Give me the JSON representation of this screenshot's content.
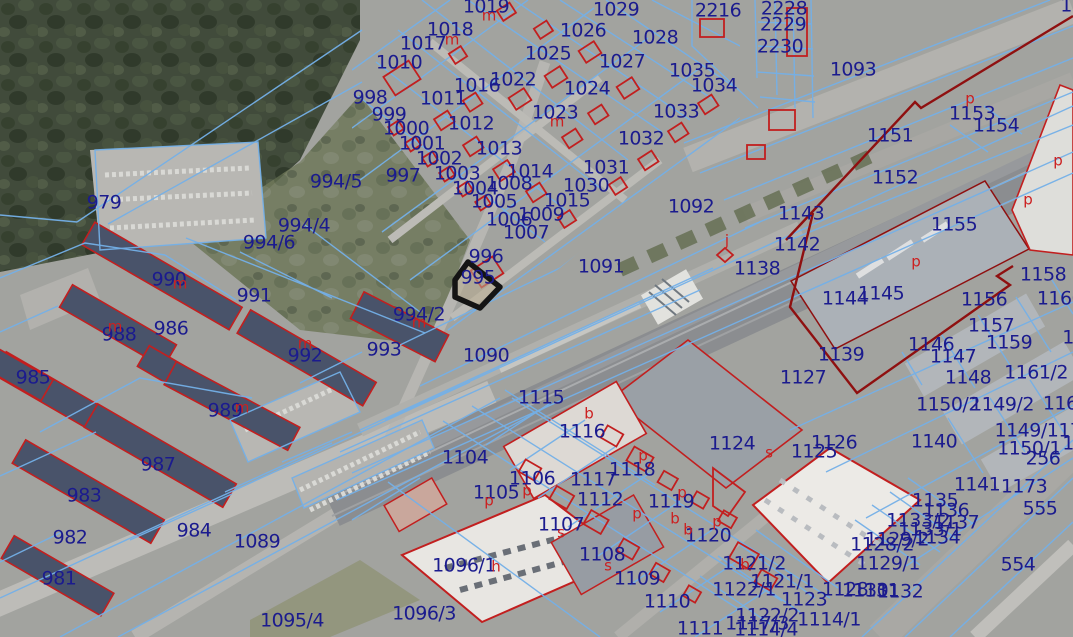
{
  "map": {
    "type": "cadastral-web-map",
    "colors": {
      "label": "#1b1b8e",
      "marker": "#cc2020",
      "boundary": "#74b0e8",
      "building_outline": "#c21f1f",
      "railway_boundary": "#8f1010",
      "selected_outline": "#141414",
      "selected_fill": "#b9ad8f"
    },
    "selected_parcel": {
      "number": "995"
    },
    "parcel_labels": [
      {
        "t": "979",
        "x": 104,
        "y": 203
      },
      {
        "t": "994/5",
        "x": 336,
        "y": 182
      },
      {
        "t": "994/4",
        "x": 304,
        "y": 226
      },
      {
        "t": "994/6",
        "x": 269,
        "y": 243
      },
      {
        "t": "990",
        "x": 169,
        "y": 280
      },
      {
        "t": "991",
        "x": 254,
        "y": 296
      },
      {
        "t": "988",
        "x": 119,
        "y": 335
      },
      {
        "t": "986",
        "x": 171,
        "y": 329
      },
      {
        "t": "992",
        "x": 305,
        "y": 356
      },
      {
        "t": "985",
        "x": 33,
        "y": 378
      },
      {
        "t": "989",
        "x": 225,
        "y": 411
      },
      {
        "t": "987",
        "x": 158,
        "y": 465
      },
      {
        "t": "983",
        "x": 84,
        "y": 496
      },
      {
        "t": "982",
        "x": 70,
        "y": 538
      },
      {
        "t": "984",
        "x": 194,
        "y": 531
      },
      {
        "t": "1089",
        "x": 257,
        "y": 542
      },
      {
        "t": "981",
        "x": 59,
        "y": 579
      },
      {
        "t": "1095/4",
        "x": 292,
        "y": 621
      },
      {
        "t": "993",
        "x": 384,
        "y": 350
      },
      {
        "t": "994/2",
        "x": 419,
        "y": 315
      },
      {
        "t": "1019",
        "x": 486,
        "y": 7
      },
      {
        "t": "1029",
        "x": 616,
        "y": 10
      },
      {
        "t": "1018",
        "x": 450,
        "y": 30
      },
      {
        "t": "1017",
        "x": 423,
        "y": 44
      },
      {
        "t": "1026",
        "x": 583,
        "y": 31
      },
      {
        "t": "1028",
        "x": 655,
        "y": 38
      },
      {
        "t": "1010",
        "x": 399,
        "y": 63
      },
      {
        "t": "1025",
        "x": 548,
        "y": 54
      },
      {
        "t": "1027",
        "x": 622,
        "y": 62
      },
      {
        "t": "1035",
        "x": 692,
        "y": 71
      },
      {
        "t": "1016",
        "x": 477,
        "y": 86
      },
      {
        "t": "1022",
        "x": 513,
        "y": 80
      },
      {
        "t": "1024",
        "x": 587,
        "y": 89
      },
      {
        "t": "1034",
        "x": 714,
        "y": 86
      },
      {
        "t": "998",
        "x": 370,
        "y": 98
      },
      {
        "t": "1011",
        "x": 443,
        "y": 99
      },
      {
        "t": "999",
        "x": 389,
        "y": 115
      },
      {
        "t": "1033",
        "x": 676,
        "y": 112
      },
      {
        "t": "1000",
        "x": 406,
        "y": 129
      },
      {
        "t": "1012",
        "x": 471,
        "y": 124
      },
      {
        "t": "1023",
        "x": 555,
        "y": 113
      },
      {
        "t": "1001",
        "x": 422,
        "y": 144
      },
      {
        "t": "1032",
        "x": 641,
        "y": 139
      },
      {
        "t": "1002",
        "x": 439,
        "y": 159
      },
      {
        "t": "1013",
        "x": 499,
        "y": 149
      },
      {
        "t": "997",
        "x": 403,
        "y": 176
      },
      {
        "t": "1003",
        "x": 457,
        "y": 174
      },
      {
        "t": "1031",
        "x": 606,
        "y": 168
      },
      {
        "t": "1004",
        "x": 475,
        "y": 189
      },
      {
        "t": "1008",
        "x": 509,
        "y": 184
      },
      {
        "t": "1014",
        "x": 530,
        "y": 172
      },
      {
        "t": "1030",
        "x": 586,
        "y": 186
      },
      {
        "t": "1005",
        "x": 494,
        "y": 202
      },
      {
        "t": "1015",
        "x": 567,
        "y": 201
      },
      {
        "t": "1006",
        "x": 509,
        "y": 220
      },
      {
        "t": "1009",
        "x": 541,
        "y": 215
      },
      {
        "t": "1007",
        "x": 526,
        "y": 233
      },
      {
        "t": "996",
        "x": 486,
        "y": 257
      },
      {
        "t": "995",
        "x": 478,
        "y": 278
      },
      {
        "t": "1091",
        "x": 601,
        "y": 267
      },
      {
        "t": "1090",
        "x": 486,
        "y": 356
      },
      {
        "t": "1092",
        "x": 691,
        "y": 207
      },
      {
        "t": "2216",
        "x": 718,
        "y": 11
      },
      {
        "t": "2228",
        "x": 784,
        "y": 9
      },
      {
        "t": "2229",
        "x": 783,
        "y": 25
      },
      {
        "t": "2230",
        "x": 780,
        "y": 47
      },
      {
        "t": "1093",
        "x": 853,
        "y": 70
      },
      {
        "t": "1153",
        "x": 972,
        "y": 114
      },
      {
        "t": "1154",
        "x": 996,
        "y": 126
      },
      {
        "t": "1151",
        "x": 890,
        "y": 136
      },
      {
        "t": "1152",
        "x": 895,
        "y": 178
      },
      {
        "t": "1",
        "x": 1066,
        "y": 6
      },
      {
        "t": "1143",
        "x": 801,
        "y": 214
      },
      {
        "t": "1155",
        "x": 954,
        "y": 225
      },
      {
        "t": "1142",
        "x": 797,
        "y": 245
      },
      {
        "t": "1138",
        "x": 757,
        "y": 269
      },
      {
        "t": "1144",
        "x": 845,
        "y": 299
      },
      {
        "t": "1145",
        "x": 881,
        "y": 294
      },
      {
        "t": "1158",
        "x": 1043,
        "y": 275
      },
      {
        "t": "1156",
        "x": 984,
        "y": 300
      },
      {
        "t": "1160",
        "x": 1060,
        "y": 299
      },
      {
        "t": "1157",
        "x": 991,
        "y": 326
      },
      {
        "t": "1159",
        "x": 1009,
        "y": 343
      },
      {
        "t": "1146",
        "x": 931,
        "y": 345
      },
      {
        "t": "1147",
        "x": 953,
        "y": 357
      },
      {
        "t": "1139",
        "x": 841,
        "y": 355
      },
      {
        "t": "1148",
        "x": 968,
        "y": 378
      },
      {
        "t": "1127",
        "x": 803,
        "y": 378
      },
      {
        "t": "1161/2",
        "x": 1036,
        "y": 373
      },
      {
        "t": "1150/2",
        "x": 948,
        "y": 405
      },
      {
        "t": "1149/2",
        "x": 1002,
        "y": 405
      },
      {
        "t": "1161",
        "x": 1066,
        "y": 404
      },
      {
        "t": "1",
        "x": 1068,
        "y": 338
      },
      {
        "t": "1124",
        "x": 732,
        "y": 444
      },
      {
        "t": "1126",
        "x": 834,
        "y": 443
      },
      {
        "t": "1125",
        "x": 814,
        "y": 452
      },
      {
        "t": "1140",
        "x": 934,
        "y": 442
      },
      {
        "t": "1149/117",
        "x": 1038,
        "y": 431
      },
      {
        "t": "1150/1",
        "x": 1029,
        "y": 449
      },
      {
        "t": "256",
        "x": 1043,
        "y": 459
      },
      {
        "t": "1",
        "x": 1068,
        "y": 444
      },
      {
        "t": "1141",
        "x": 977,
        "y": 485
      },
      {
        "t": "1173",
        "x": 1024,
        "y": 487
      },
      {
        "t": "1135",
        "x": 935,
        "y": 501
      },
      {
        "t": "1136",
        "x": 946,
        "y": 511
      },
      {
        "t": "555",
        "x": 1040,
        "y": 509
      },
      {
        "t": "1133/2",
        "x": 918,
        "y": 521
      },
      {
        "t": "1137",
        "x": 956,
        "y": 523
      },
      {
        "t": "1133/1",
        "x": 930,
        "y": 530
      },
      {
        "t": "1129/2",
        "x": 897,
        "y": 540
      },
      {
        "t": "1134",
        "x": 937,
        "y": 538
      },
      {
        "t": "1128/2",
        "x": 882,
        "y": 545
      },
      {
        "t": "1129/1",
        "x": 888,
        "y": 564
      },
      {
        "t": "554",
        "x": 1018,
        "y": 565
      },
      {
        "t": "1120",
        "x": 708,
        "y": 536
      },
      {
        "t": "1121/2",
        "x": 754,
        "y": 564
      },
      {
        "t": "1121/1",
        "x": 782,
        "y": 582
      },
      {
        "t": "1122/1",
        "x": 744,
        "y": 590
      },
      {
        "t": "1123",
        "x": 804,
        "y": 600
      },
      {
        "t": "1128",
        "x": 845,
        "y": 590
      },
      {
        "t": "1130",
        "x": 865,
        "y": 591
      },
      {
        "t": "1131",
        "x": 876,
        "y": 591
      },
      {
        "t": "1132",
        "x": 900,
        "y": 592
      },
      {
        "t": "1122/2",
        "x": 767,
        "y": 616
      },
      {
        "t": "1114/1",
        "x": 829,
        "y": 620
      },
      {
        "t": "1117/3",
        "x": 757,
        "y": 624
      },
      {
        "t": "1114/4",
        "x": 766,
        "y": 630
      },
      {
        "t": "1111",
        "x": 700,
        "y": 629
      },
      {
        "t": "1115",
        "x": 541,
        "y": 398
      },
      {
        "t": "1116",
        "x": 582,
        "y": 432
      },
      {
        "t": "1104",
        "x": 465,
        "y": 458
      },
      {
        "t": "1118",
        "x": 632,
        "y": 470
      },
      {
        "t": "1106",
        "x": 532,
        "y": 479
      },
      {
        "t": "1117",
        "x": 593,
        "y": 480
      },
      {
        "t": "1105",
        "x": 496,
        "y": 493
      },
      {
        "t": "1112",
        "x": 600,
        "y": 500
      },
      {
        "t": "1119",
        "x": 671,
        "y": 502
      },
      {
        "t": "1107",
        "x": 561,
        "y": 525
      },
      {
        "t": "1108",
        "x": 602,
        "y": 555
      },
      {
        "t": "1096/1",
        "x": 464,
        "y": 566
      },
      {
        "t": "1109",
        "x": 637,
        "y": 579
      },
      {
        "t": "1110",
        "x": 667,
        "y": 602
      },
      {
        "t": "1096/3",
        "x": 424,
        "y": 614
      }
    ],
    "building_markers": [
      {
        "t": "m",
        "x": 180,
        "y": 284
      },
      {
        "t": "m",
        "x": 115,
        "y": 327
      },
      {
        "t": "m",
        "x": 305,
        "y": 344
      },
      {
        "t": "m",
        "x": 242,
        "y": 408
      },
      {
        "t": "m",
        "x": 419,
        "y": 323
      },
      {
        "t": "m",
        "x": 489,
        "y": 16
      },
      {
        "t": "m",
        "x": 452,
        "y": 40
      },
      {
        "t": "m",
        "x": 557,
        "y": 122
      },
      {
        "t": "j",
        "x": 727,
        "y": 241
      },
      {
        "t": "p",
        "x": 970,
        "y": 99
      },
      {
        "t": "p",
        "x": 1058,
        "y": 161
      },
      {
        "t": "p",
        "x": 1028,
        "y": 200
      },
      {
        "t": "p",
        "x": 916,
        "y": 262
      },
      {
        "t": "s",
        "x": 769,
        "y": 453
      },
      {
        "t": "p",
        "x": 717,
        "y": 522
      },
      {
        "t": "b",
        "x": 745,
        "y": 565
      },
      {
        "t": "p",
        "x": 643,
        "y": 456
      },
      {
        "t": "p",
        "x": 527,
        "y": 491
      },
      {
        "t": "p",
        "x": 489,
        "y": 501
      },
      {
        "t": "p",
        "x": 682,
        "y": 493
      },
      {
        "t": "p",
        "x": 637,
        "y": 514
      },
      {
        "t": "b",
        "x": 675,
        "y": 519
      },
      {
        "t": "b",
        "x": 688,
        "y": 530
      },
      {
        "t": "s",
        "x": 561,
        "y": 533
      },
      {
        "t": "s",
        "x": 608,
        "y": 566
      },
      {
        "t": "h",
        "x": 496,
        "y": 567
      },
      {
        "t": "b",
        "x": 589,
        "y": 414
      }
    ]
  }
}
